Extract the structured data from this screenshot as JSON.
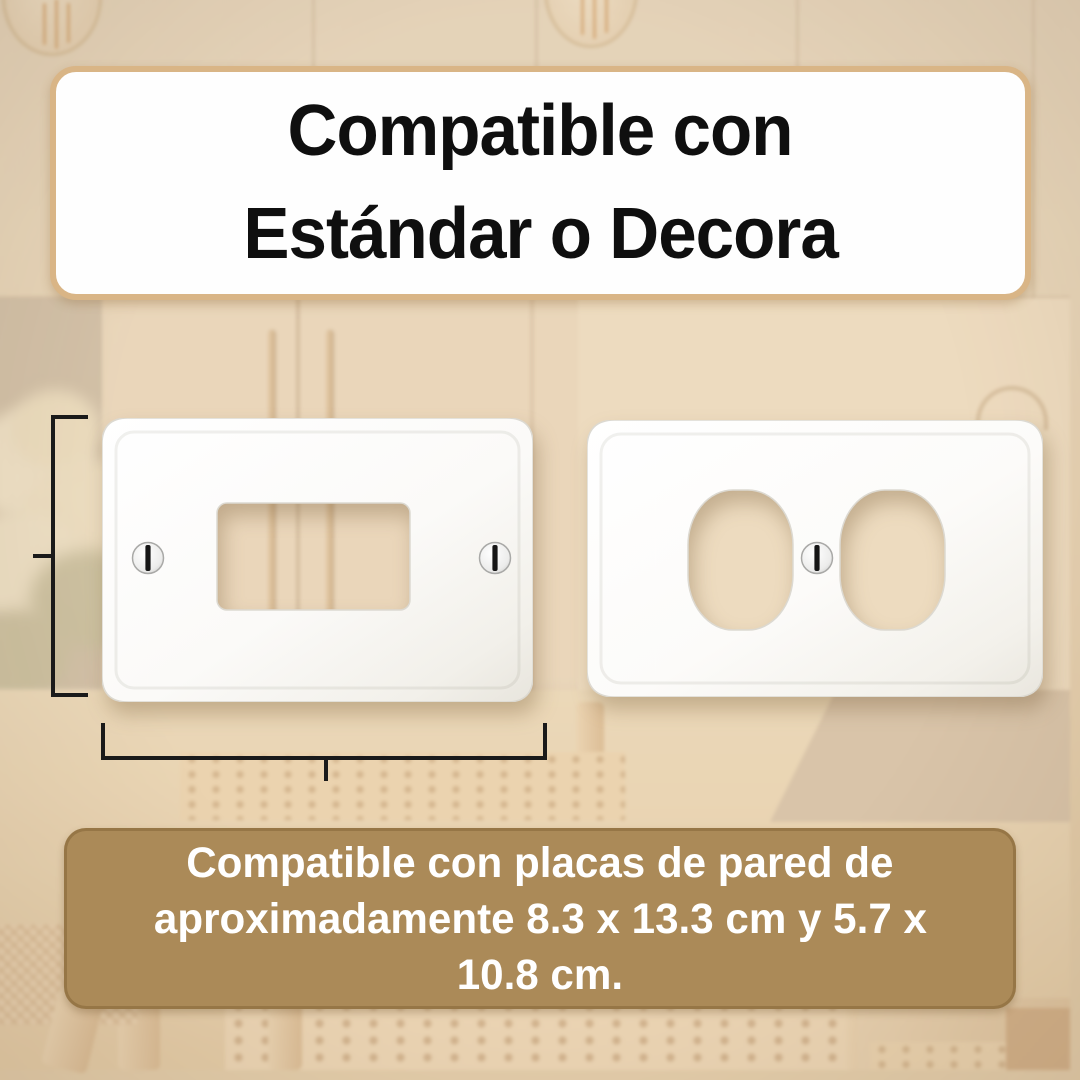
{
  "header_card": {
    "line1": "Compatible con",
    "line2": "Estándar o Decora"
  },
  "footer_card": {
    "line1": "Compatible con placas de pared de",
    "line2": "aproximadamente 8.3 x 13.3 cm y 5.7 x",
    "line3": "10.8 cm."
  },
  "colors": {
    "accent": "#ab8a58",
    "cardBorder": "#d9b586",
    "headingText": "#0f0f0f",
    "footerText": "#ffffff",
    "dim": "#1a1a1a"
  },
  "graphics": {
    "left_plate": "decora-blank-wallplate",
    "right_plate": "duplex-outlet-wallplate",
    "screw": "slotted-screw",
    "height_dimension": "height-dimension-bracket",
    "width_dimension": "width-dimension-bracket"
  }
}
